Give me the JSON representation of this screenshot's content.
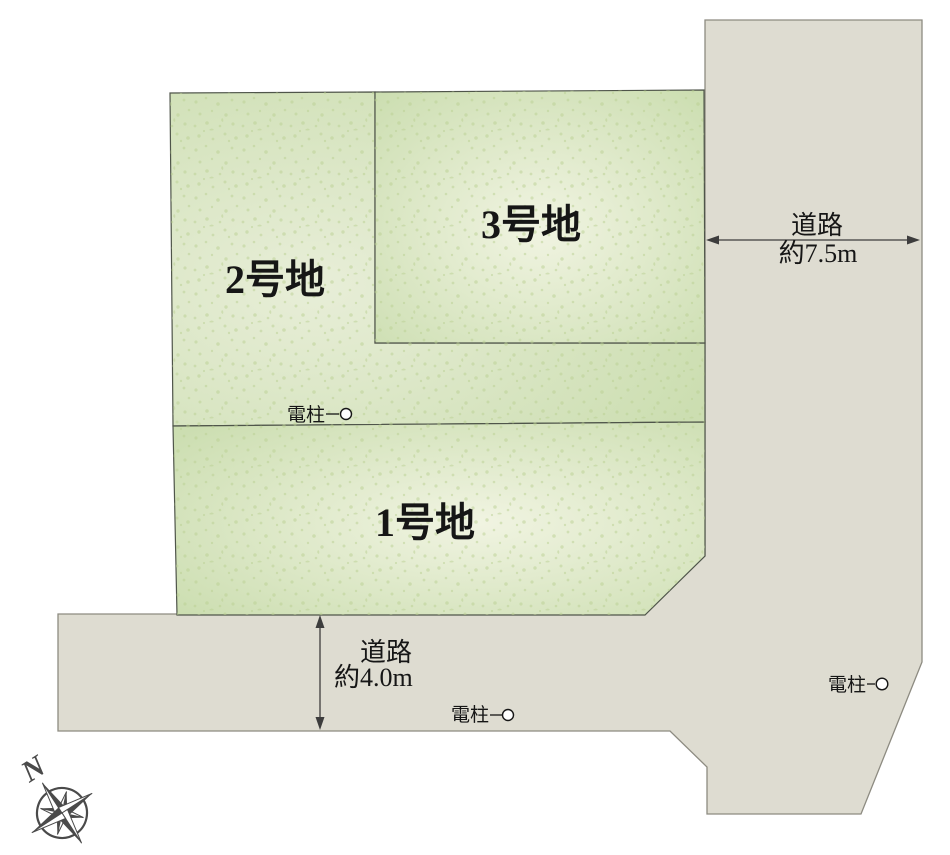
{
  "diagram": {
    "plots": [
      {
        "label": "1号地"
      },
      {
        "label": "2号地"
      },
      {
        "label": "3号地"
      }
    ],
    "road_right": {
      "name": "道路",
      "width": "約7.5m"
    },
    "road_bottom": {
      "name": "道路",
      "width": "約4.0m"
    },
    "poles": [
      {
        "label": "電柱"
      },
      {
        "label": "電柱"
      },
      {
        "label": "電柱"
      }
    ],
    "compass": {
      "north": "N"
    }
  },
  "colors": {
    "background": "#ffffff",
    "plot_green_edge": "#ccdeb1",
    "plot_green_center": "#f1f4e2",
    "plot2_green_center": "#e8eed8",
    "speckle": "#b9cf92",
    "plot_border": "#4f554a",
    "road_fill": "#dedcd1",
    "road_border": "#8d8b81",
    "text": "#161616",
    "arrow": "#3d3d3d",
    "compass": "#4a4a4a",
    "pole_circle_fill": "#ffffff"
  }
}
